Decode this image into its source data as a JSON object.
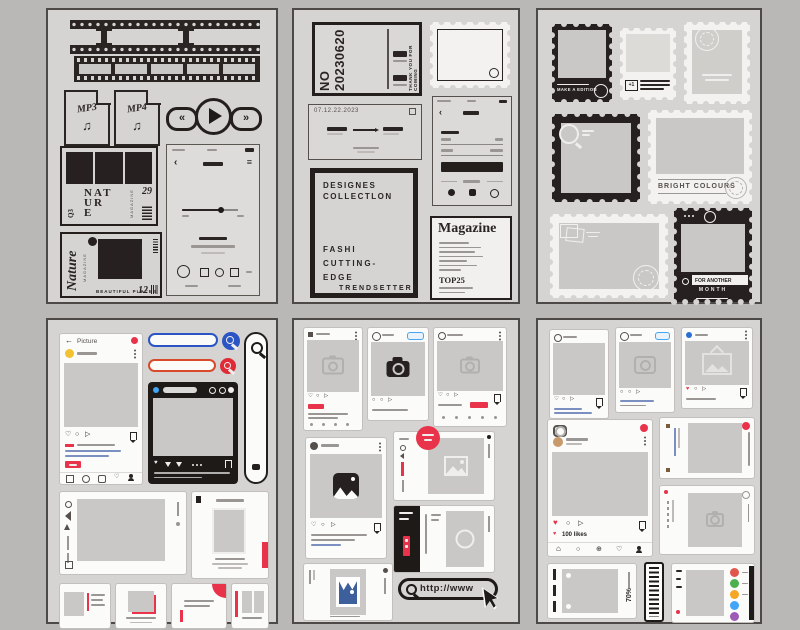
{
  "colors": {
    "background": "#b9b8b6",
    "sheet": "#d5d4d2",
    "ink": "#2a2523",
    "accent_red": "#e8334a",
    "accent_orange_red": "#d84a2b",
    "accent_blue": "#2b55c4",
    "link_blue": "#7b8fc0",
    "avatar_yellow": "#f2c230",
    "avatar_tan": "#c89a6b",
    "social_icon_colors": [
      "#e2574c",
      "#4caf50",
      "#f5a623",
      "#42a5f5",
      "#9c5bb5"
    ]
  },
  "icons": {
    "back": "←",
    "chevron_left": "‹",
    "menu": "≡",
    "rewind": "«",
    "forward": "»",
    "note": "♫",
    "heart_outline": "♡",
    "heart_filled": "♥",
    "circle": "○",
    "send": "▷",
    "home": "⌂",
    "plus": "⊕"
  },
  "sheet1": {
    "mp3": "MP3",
    "mp4": "MP4",
    "mag1": {
      "issue": "Q3",
      "t1": "NAT",
      "t2": "UR",
      "t3": "E",
      "brand": "MAGAZINE",
      "num": "29"
    },
    "mag2": {
      "title": "Nature",
      "brand": "MAGAZINE",
      "tag": "BEAUTIFUL PLACES",
      "num": "12"
    }
  },
  "sheet2": {
    "ticket_no": "NO 20230620",
    "thanks": "THANK YOU FOR COMING",
    "date": "07.12.22.2023",
    "design": {
      "l1": "DESIGNES",
      "l2": "COLLECTLON",
      "l3": "FASHI",
      "l4": "CUTTING-",
      "l5": "EDGE",
      "l6": "TRENDSETTERS"
    },
    "magazine": {
      "title": "Magazine",
      "top": "TOP25"
    }
  },
  "sheet3": {
    "edition": "MAKE A EDITION",
    "plus_one": "+1",
    "bright": "BRIGHT COLOURS",
    "for_another": "FOR ANOTHER",
    "month": "MONTH"
  },
  "sheet4": {
    "picture": "Picture"
  },
  "sheet5": {
    "url": "http://www"
  },
  "sheet6": {
    "likes": "100 likes",
    "percent": "70%"
  }
}
